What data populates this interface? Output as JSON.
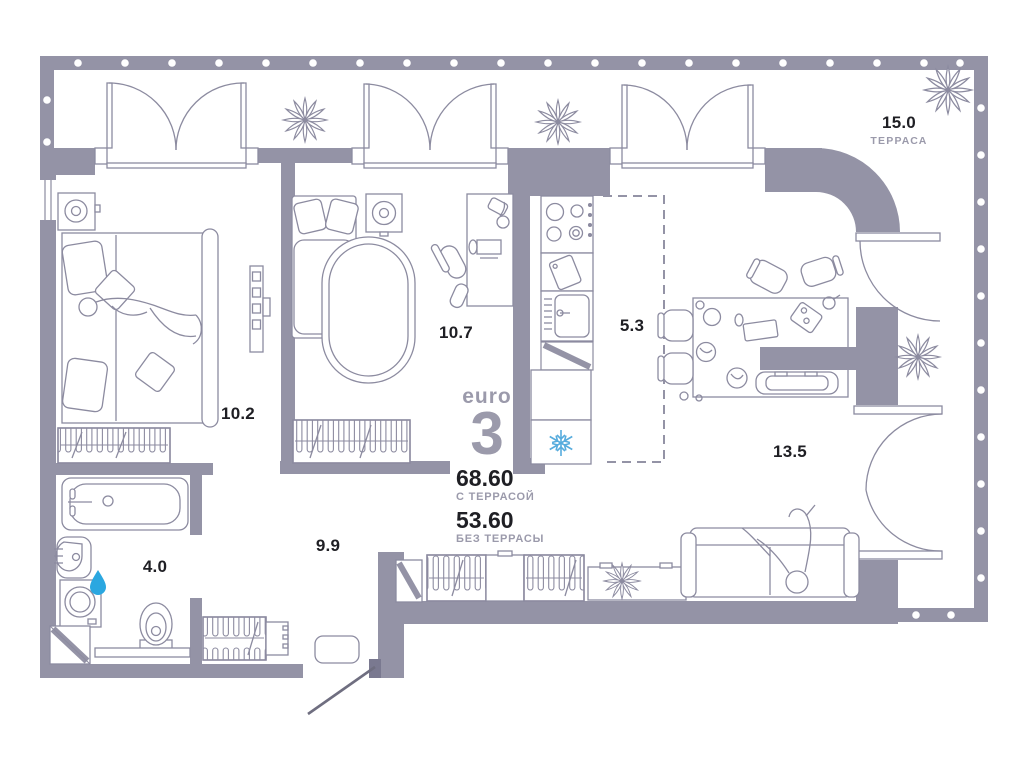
{
  "plan": {
    "brand": {
      "prefix": "euro",
      "number": "3"
    },
    "totals": {
      "with_terrace": {
        "value": "68.60",
        "label": "С ТЕРРАСОЙ"
      },
      "without_terrace": {
        "value": "53.60",
        "label": "БЕЗ ТЕРРАСЫ"
      }
    },
    "rooms": [
      {
        "id": "terrace",
        "area": "15.0",
        "label": "ТЕРРАСА"
      },
      {
        "id": "bedroom-1",
        "area": "10.2"
      },
      {
        "id": "bedroom-2",
        "area": "10.7"
      },
      {
        "id": "kitchen",
        "area": "5.3"
      },
      {
        "id": "living-room",
        "area": "13.5"
      },
      {
        "id": "bathroom",
        "area": "4.0"
      },
      {
        "id": "hallway",
        "area": "9.9"
      }
    ],
    "icons": {
      "fridge": "snowflake-icon",
      "bathroom": "water-drop-icon",
      "decor": "plant-icon"
    },
    "colors": {
      "wall": "#9493A6",
      "furniture_line": "#8C8BA0",
      "label_dark": "#1F1F24",
      "label_gray": "#9B9AAB",
      "snowflake_blue": "#57ACDD",
      "water_drop_blue": "#2BA7E0"
    }
  }
}
